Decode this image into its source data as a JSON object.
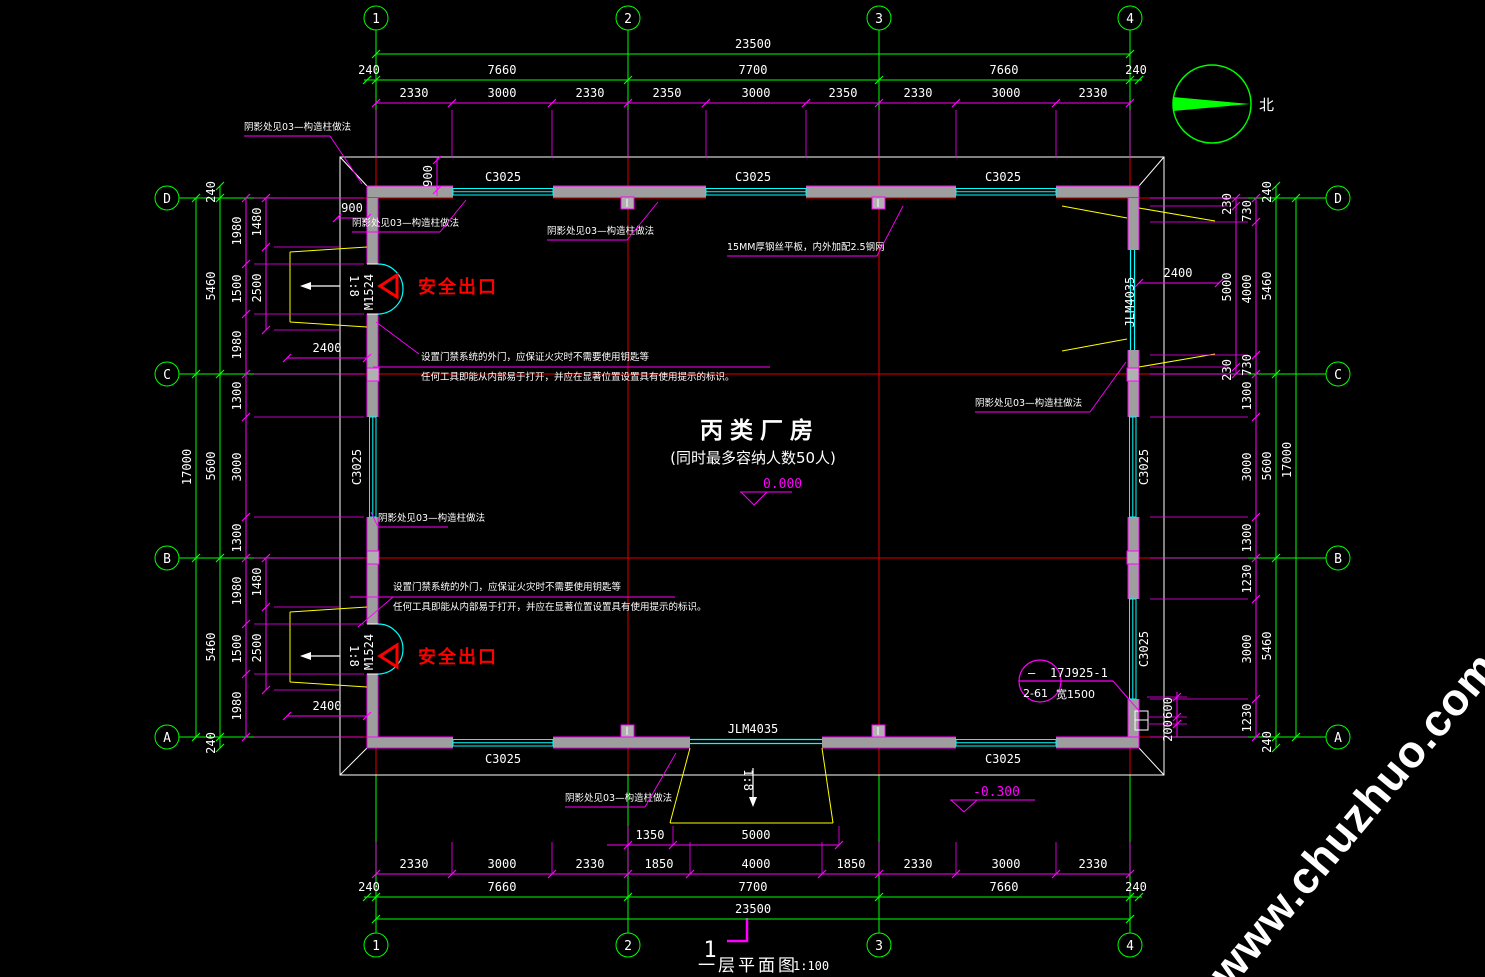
{
  "title": {
    "number": "1",
    "name": "一层平面图",
    "scale": "1:100"
  },
  "room": {
    "name": "丙类厂房",
    "capacity_note": "(同时最多容纳人数50人)"
  },
  "levels": {
    "floor": "0.000",
    "outdoor": "-0.300"
  },
  "north_label": "北",
  "exit_label": "安全出口",
  "slope_label": "1:8",
  "watermark": "www.chuzhuo.com",
  "grid": {
    "cols": [
      "1",
      "2",
      "3",
      "4"
    ],
    "rows": [
      "D",
      "C",
      "B",
      "A"
    ]
  },
  "openings": {
    "window": "C3025",
    "door_side": "M1524",
    "door_main": "JLM4035"
  },
  "detail_ref": {
    "dash": "—",
    "atlas": "17J925-1",
    "page": "2-61",
    "width": "宽1500"
  },
  "colors": {
    "grid_green": "#00ff00",
    "dim_magenta": "#ff00ff",
    "axis_red": "#ff0000",
    "window_cyan": "#00ffff",
    "ramp_yellow": "#ffff00",
    "wall_gray": "#9e9e9e"
  },
  "dim_rows": [
    {
      "o": "h",
      "c": "G",
      "y": 54,
      "x1": 376,
      "x2": 1130,
      "ticks": [
        376,
        1130
      ],
      "labels": [
        {
          "t": "23500",
          "x": 753
        }
      ]
    },
    {
      "o": "h",
      "c": "G",
      "y": 80,
      "x1": 364,
      "x2": 1142,
      "ticks": [
        367,
        376,
        628,
        879,
        1130,
        1139
      ],
      "labels": [
        {
          "t": "240",
          "x": 369
        },
        {
          "t": "7660",
          "x": 502
        },
        {
          "t": "7700",
          "x": 753
        },
        {
          "t": "7660",
          "x": 1004
        },
        {
          "t": "240",
          "x": 1136
        }
      ]
    },
    {
      "o": "h",
      "c": "M",
      "y": 103,
      "x1": 376,
      "x2": 1130,
      "ticks": [
        376,
        452,
        552,
        628,
        706,
        806,
        879,
        956,
        1056,
        1130
      ],
      "ext": [
        110,
        158
      ],
      "labels": [
        {
          "t": "2330",
          "x": 414
        },
        {
          "t": "3000",
          "x": 502
        },
        {
          "t": "2330",
          "x": 590
        },
        {
          "t": "2350",
          "x": 667
        },
        {
          "t": "3000",
          "x": 756
        },
        {
          "t": "2350",
          "x": 843
        },
        {
          "t": "2330",
          "x": 918
        },
        {
          "t": "3000",
          "x": 1006
        },
        {
          "t": "2330",
          "x": 1093
        }
      ]
    },
    {
      "o": "h",
      "c": "M",
      "y": 845,
      "x1": 607,
      "x2": 839,
      "ticks": [
        628,
        673,
        839
      ],
      "ext": [
        826,
        845
      ],
      "labels": [
        {
          "t": "1350",
          "x": 650
        },
        {
          "t": "5000",
          "x": 756
        }
      ]
    },
    {
      "o": "h",
      "c": "M",
      "y": 874,
      "x1": 376,
      "x2": 1130,
      "ticks": [
        376,
        452,
        552,
        628,
        690,
        822,
        879,
        956,
        1056,
        1130
      ],
      "ext": [
        842,
        874
      ],
      "labels": [
        {
          "t": "2330",
          "x": 414
        },
        {
          "t": "3000",
          "x": 502
        },
        {
          "t": "2330",
          "x": 590
        },
        {
          "t": "1850",
          "x": 659
        },
        {
          "t": "4000",
          "x": 756
        },
        {
          "t": "1850",
          "x": 851
        },
        {
          "t": "2330",
          "x": 918
        },
        {
          "t": "3000",
          "x": 1006
        },
        {
          "t": "2330",
          "x": 1093
        }
      ]
    },
    {
      "o": "h",
      "c": "G",
      "y": 897,
      "x1": 364,
      "x2": 1142,
      "ticks": [
        367,
        376,
        628,
        879,
        1130,
        1139
      ],
      "labels": [
        {
          "t": "240",
          "x": 369
        },
        {
          "t": "7660",
          "x": 502
        },
        {
          "t": "7700",
          "x": 753
        },
        {
          "t": "7660",
          "x": 1004
        },
        {
          "t": "240",
          "x": 1136
        }
      ]
    },
    {
      "o": "h",
      "c": "G",
      "y": 919,
      "x1": 376,
      "x2": 1130,
      "ticks": [
        376,
        1130
      ],
      "labels": [
        {
          "t": "23500",
          "x": 753
        }
      ]
    },
    {
      "o": "v",
      "c": "G",
      "x": 196,
      "y1": 198,
      "y2": 737,
      "ticks": [
        198,
        374,
        558,
        737
      ],
      "labels": [
        {
          "t": "17000",
          "y": 467
        }
      ]
    },
    {
      "o": "v",
      "c": "G",
      "x": 220,
      "y1": 186,
      "y2": 748,
      "ticks": [
        186,
        198,
        374,
        558,
        737,
        748
      ],
      "labels": [
        {
          "t": "240",
          "y": 192
        },
        {
          "t": "5460",
          "y": 286
        },
        {
          "t": "5600",
          "y": 466
        },
        {
          "t": "5460",
          "y": 647
        },
        {
          "t": "240",
          "y": 743
        }
      ]
    },
    {
      "o": "v",
      "c": "M",
      "x": 246,
      "y1": 198,
      "y2": 737,
      "ticks": [
        198,
        264,
        314,
        374,
        417,
        517,
        558,
        624,
        674,
        737
      ],
      "ext": [
        254,
        364
      ],
      "labels": [
        {
          "t": "1980",
          "y": 231
        },
        {
          "t": "1500",
          "y": 289
        },
        {
          "t": "1980",
          "y": 345
        },
        {
          "t": "1300",
          "y": 396
        },
        {
          "t": "3000",
          "y": 467
        },
        {
          "t": "1300",
          "y": 538
        },
        {
          "t": "1980",
          "y": 591
        },
        {
          "t": "1500",
          "y": 649
        },
        {
          "t": "1980",
          "y": 706
        }
      ]
    },
    {
      "o": "v",
      "c": "M",
      "x": 266,
      "y1": 198,
      "y2": 330,
      "ticks": [
        198,
        247,
        330
      ],
      "ext": [
        274,
        340
      ],
      "labels": [
        {
          "t": "1480",
          "y": 222
        },
        {
          "t": "2500",
          "y": 288
        }
      ]
    },
    {
      "o": "v",
      "c": "M",
      "x": 266,
      "y1": 558,
      "y2": 690,
      "ticks": [
        558,
        607,
        690
      ],
      "ext": [
        274,
        340
      ],
      "labels": [
        {
          "t": "1480",
          "y": 582
        },
        {
          "t": "2500",
          "y": 648
        }
      ]
    },
    {
      "o": "h",
      "c": "M",
      "y": 358,
      "x1": 287,
      "x2": 367,
      "ticks": [
        287,
        367
      ],
      "labels": [
        {
          "t": "2400",
          "x": 327
        }
      ]
    },
    {
      "o": "h",
      "c": "M",
      "y": 716,
      "x1": 287,
      "x2": 367,
      "ticks": [
        287,
        367
      ],
      "labels": [
        {
          "t": "2400",
          "x": 327
        }
      ]
    },
    {
      "o": "v",
      "c": "M",
      "x": 437,
      "y1": 158,
      "y2": 196,
      "ticks": [
        160,
        190
      ],
      "labels": [
        {
          "t": "900",
          "y": 176
        }
      ]
    },
    {
      "o": "h",
      "c": "M",
      "y": 218,
      "x1": 337,
      "x2": 367,
      "ticks": [
        337,
        367
      ],
      "labels": [
        {
          "t": "900",
          "x": 352
        }
      ]
    },
    {
      "o": "v",
      "c": "M",
      "x": 1236,
      "y1": 198,
      "y2": 374,
      "ticks": [
        198,
        206,
        367,
        374
      ],
      "ext": [
        1150,
        1228
      ],
      "labels": [
        {
          "t": "230",
          "y": 204
        },
        {
          "t": "5000",
          "y": 287
        },
        {
          "t": "230",
          "y": 370
        }
      ]
    },
    {
      "o": "v",
      "c": "M",
      "x": 1256,
      "y1": 198,
      "y2": 737,
      "ticks": [
        198,
        222,
        355,
        374,
        417,
        517,
        558,
        599,
        699,
        737
      ],
      "ext": [
        1150,
        1248
      ],
      "labels": [
        {
          "t": "730",
          "y": 211
        },
        {
          "t": "4000",
          "y": 289
        },
        {
          "t": "730",
          "y": 365
        },
        {
          "t": "1300",
          "y": 396
        },
        {
          "t": "3000",
          "y": 467
        },
        {
          "t": "1300",
          "y": 538
        },
        {
          "t": "1230",
          "y": 579
        },
        {
          "t": "3000",
          "y": 649
        },
        {
          "t": "1230",
          "y": 718
        }
      ]
    },
    {
      "o": "v",
      "c": "G",
      "x": 1276,
      "y1": 186,
      "y2": 748,
      "ticks": [
        186,
        198,
        374,
        558,
        737,
        748
      ],
      "labels": [
        {
          "t": "240",
          "y": 192
        },
        {
          "t": "5460",
          "y": 286
        },
        {
          "t": "5600",
          "y": 466
        },
        {
          "t": "5460",
          "y": 646
        },
        {
          "t": "240",
          "y": 742
        }
      ]
    },
    {
      "o": "v",
      "c": "G",
      "x": 1296,
      "y1": 198,
      "y2": 737,
      "ticks": [
        198,
        737
      ],
      "labels": [
        {
          "t": "17000",
          "y": 460
        }
      ]
    },
    {
      "o": "h",
      "c": "M",
      "y": 283,
      "x1": 1139,
      "x2": 1219,
      "ticks": [
        1139,
        1219
      ],
      "labels": [
        {
          "t": "2400",
          "x": 1178
        }
      ]
    },
    {
      "o": "v",
      "c": "M",
      "x": 1177,
      "y1": 692,
      "y2": 737,
      "ticks": [
        697,
        717,
        724
      ],
      "ext": [
        1147,
        1187
      ],
      "labels": [
        {
          "t": "600",
          "y": 708
        },
        {
          "t": "200",
          "y": 731
        }
      ]
    }
  ],
  "notes": [
    {
      "t": "阴影处见03—构造柱做法",
      "x": 244,
      "y": 130,
      "u": [
        244,
        136,
        330,
        136
      ],
      "l": [
        330,
        136,
        362,
        184
      ]
    },
    {
      "t": "阴影处见03—构造柱做法",
      "x": 352,
      "y": 226,
      "u": [
        352,
        232,
        440,
        232
      ],
      "l": [
        440,
        232,
        466,
        200
      ]
    },
    {
      "t": "阴影处见03—构造柱做法",
      "x": 547,
      "y": 234,
      "u": [
        547,
        240,
        627,
        240
      ],
      "l": [
        627,
        240,
        658,
        202
      ]
    },
    {
      "t": "15MM厚钢丝平板，内外加配2.5钢网",
      "x": 727,
      "y": 250,
      "u": [
        727,
        256,
        877,
        256
      ],
      "l": [
        877,
        256,
        903,
        206
      ]
    },
    {
      "t": "阴影处见03—构造柱做法",
      "x": 975,
      "y": 406,
      "u": [
        975,
        412,
        1090,
        412
      ],
      "l": [
        1090,
        412,
        1126,
        362
      ]
    },
    {
      "t": "阴影处见03—构造柱做法",
      "x": 378,
      "y": 521,
      "u": [
        378,
        527,
        448,
        527
      ],
      "l": [
        378,
        527,
        371,
        512
      ]
    },
    {
      "t": "阴影处见03—构造柱做法",
      "x": 565,
      "y": 801,
      "u": [
        565,
        807,
        645,
        807
      ],
      "l": [
        645,
        807,
        676,
        753
      ]
    },
    {
      "t": "设置门禁系统的外门，应保证火灾时不需要使用钥匙等",
      "x": 421,
      "y": 360
    },
    {
      "t": "任何工具即能从内部易于打开，并应在显著位置设置具有使用提示的标识。",
      "x": 421,
      "y": 380,
      "u": [
        373,
        367,
        770,
        367
      ],
      "l": [
        376,
        322,
        419,
        354
      ]
    },
    {
      "t": "设置门禁系统的外门，应保证火灾时不需要使用钥匙等",
      "x": 393,
      "y": 590
    },
    {
      "t": "任何工具即能从内部易于打开，并应在显著位置设置具有使用提示的标识。",
      "x": 393,
      "y": 610,
      "u": [
        350,
        597,
        675,
        597
      ],
      "l": [
        393,
        597,
        358,
        627
      ]
    }
  ]
}
